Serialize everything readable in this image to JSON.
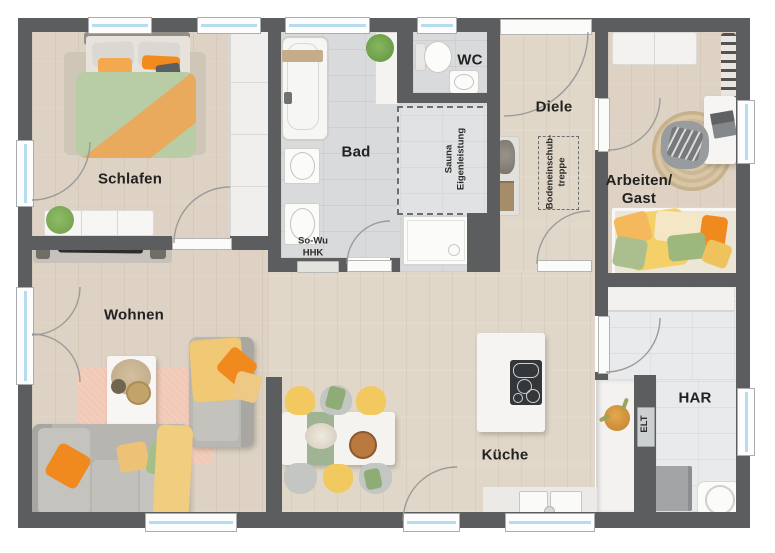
{
  "labels": {
    "schlafen": "Schlafen",
    "bad": "Bad",
    "wc": "WC",
    "diele": "Diele",
    "arbeiten_line1": "Arbeiten/",
    "arbeiten_line2": "Gast",
    "wohnen": "Wohnen",
    "kueche": "Küche",
    "har": "HAR",
    "sauna_line1": "Sauna",
    "sauna_line2": "Eigenleistung",
    "treppe_line1": "Bodeneinschub-",
    "treppe_line2": "treppe",
    "sowu_line1": "So-Wu",
    "sowu_line2": "HHK",
    "elt": "ELT"
  },
  "colors": {
    "wall": "#5b5d5f",
    "wood": "#ddd2c3",
    "tile": "#d8dadb",
    "tile_light": "#e9eaeb",
    "glass": "#b5dcef",
    "arc": "#9b9b9b",
    "label": "#222222",
    "rug_pink": "#f1c9b6",
    "rug_jute": "#d3bd9b",
    "sofa_gray": "#b7b5b0",
    "accent_orange": "#f08a1f",
    "accent_yellow": "#f2c95e",
    "accent_green": "#a4bf8a"
  }
}
